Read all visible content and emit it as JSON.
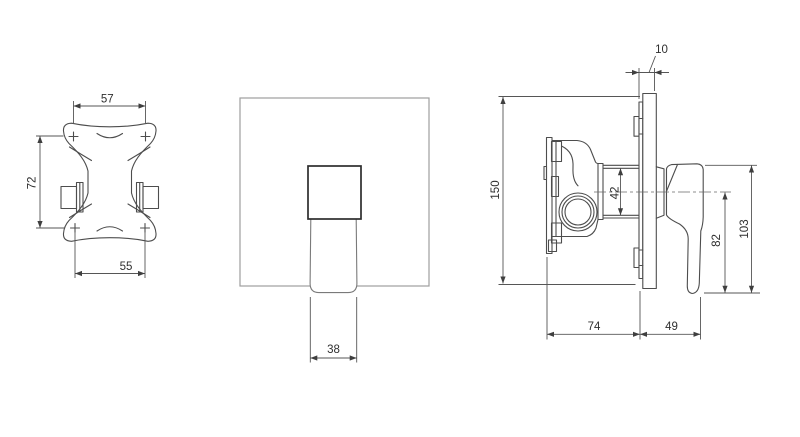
{
  "dimensions": {
    "bracket_top_hole_spacing": "57",
    "bracket_vertical_hole_spacing": "72",
    "bracket_bottom_hole_spacing": "55",
    "handle_width": "38",
    "wall_plate_thickness": "10",
    "wall_plate_height": "150",
    "outlet_port_spacing": "42",
    "lever_length": "82",
    "handle_overall_height": "103",
    "valve_body_depth": "74",
    "handle_projection": "49"
  },
  "colors": {
    "background": "#ffffff",
    "line": "#4d4d4d",
    "dimension_line": "#565656",
    "text": "#2f2f2f"
  }
}
